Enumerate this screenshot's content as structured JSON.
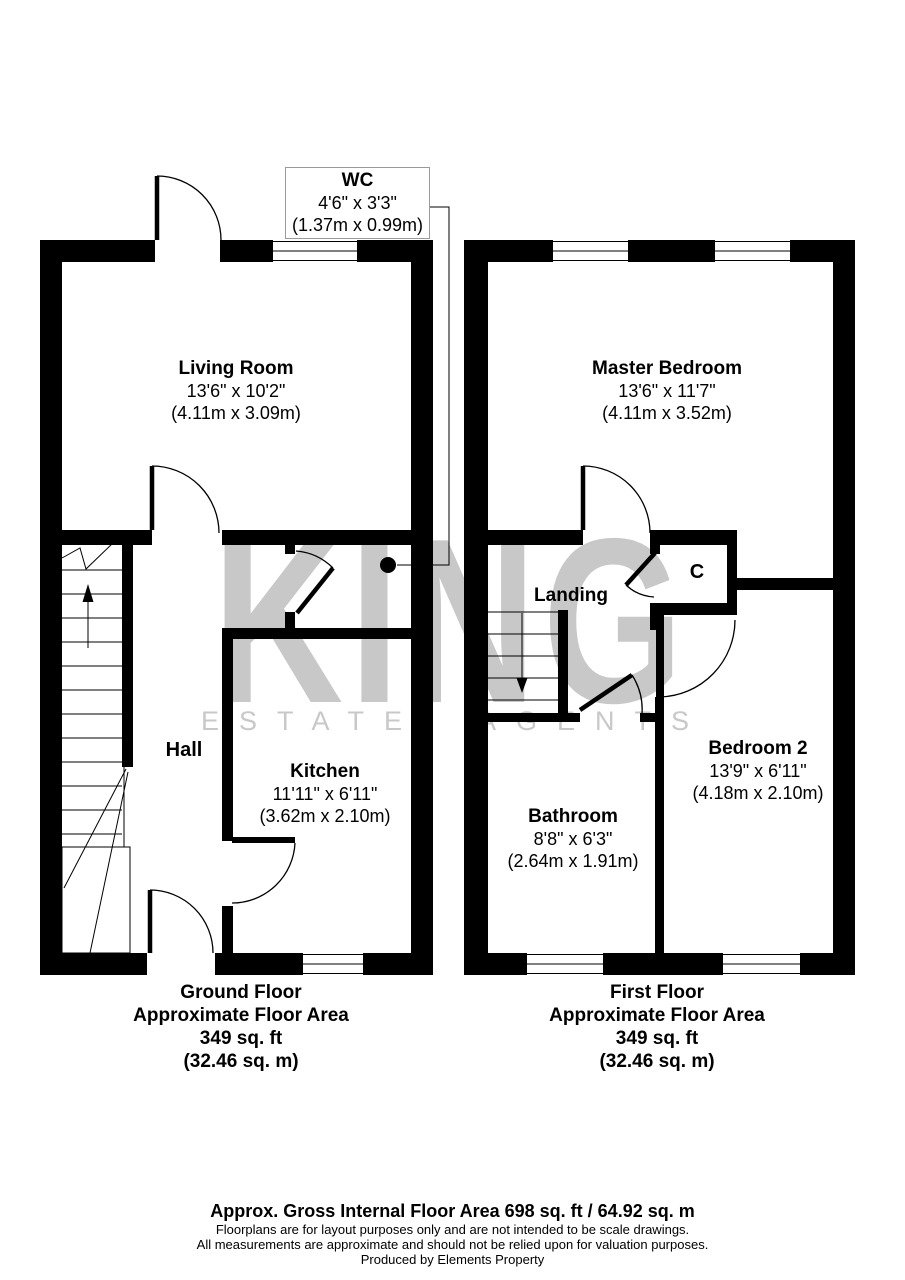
{
  "watermark": {
    "brand": "KING",
    "tagline": "ESTATE AGENTS"
  },
  "colors": {
    "wall": "#000000",
    "watermark": "#c8c8c8",
    "background": "#ffffff"
  },
  "rooms": {
    "wc": {
      "name": "WC",
      "dims_ft": "4'6\" x 3'3\"",
      "dims_m": "(1.37m x 0.99m)"
    },
    "living": {
      "name": "Living Room",
      "dims_ft": "13'6\" x 10'2\"",
      "dims_m": "(4.11m x 3.09m)"
    },
    "hall": {
      "name": "Hall"
    },
    "kitchen": {
      "name": "Kitchen",
      "dims_ft": "11'11\" x 6'11\"",
      "dims_m": "(3.62m x 2.10m)"
    },
    "master": {
      "name": "Master Bedroom",
      "dims_ft": "13'6\" x 11'7\"",
      "dims_m": "(4.11m x 3.52m)"
    },
    "landing": {
      "name": "Landing"
    },
    "cupboard": {
      "name": "C"
    },
    "bathroom": {
      "name": "Bathroom",
      "dims_ft": "8'8\" x 6'3\"",
      "dims_m": "(2.64m x 1.91m)"
    },
    "bedroom2": {
      "name": "Bedroom 2",
      "dims_ft": "13'9\" x 6'11\"",
      "dims_m": "(4.18m x 2.10m)"
    }
  },
  "captions": {
    "ground": {
      "floor": "Ground Floor",
      "label": "Approximate Floor Area",
      "area_ft": "349 sq. ft",
      "area_m": "(32.46 sq. m)"
    },
    "first": {
      "floor": "First Floor",
      "label": "Approximate Floor Area",
      "area_ft": "349 sq. ft",
      "area_m": "(32.46 sq. m)"
    }
  },
  "footer": {
    "total": "Approx. Gross Internal Floor Area 698 sq. ft / 64.92 sq. m",
    "disclaimer1": "Floorplans are for layout purposes only and are not intended to be scale drawings.",
    "disclaimer2": "All measurements are approximate and should not be relied upon for valuation purposes.",
    "credit": "Produced by Elements Property"
  }
}
